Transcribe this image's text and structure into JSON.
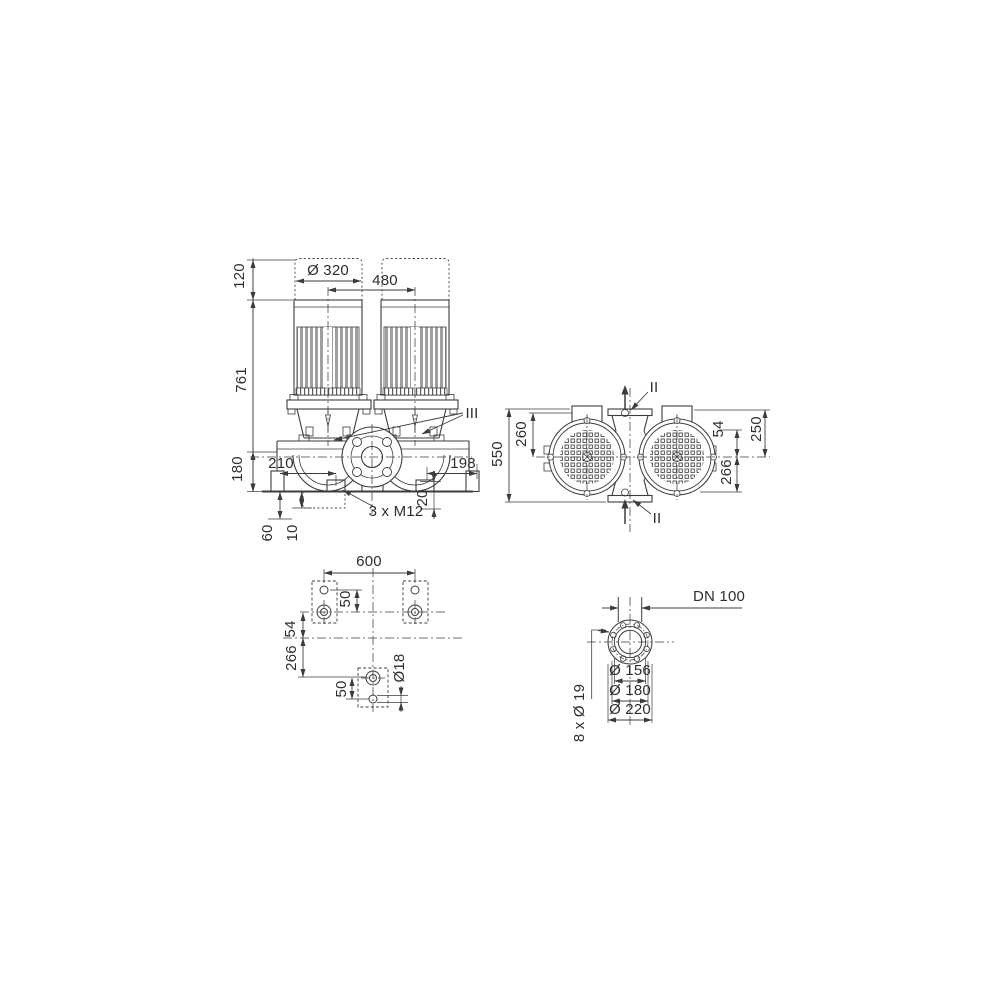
{
  "drawing": {
    "title": "Twin-head inline pump dimensional drawing",
    "colors": {
      "line": "#3c3c3c",
      "rib_fill": "#9f9f9f",
      "label": "#2e2e2e"
    },
    "front_view": {
      "dim_clearance_height": "120",
      "dim_motor_diameter": "Ø 320",
      "dim_motor_spacing": "480",
      "dim_total_height": "761",
      "dim_port_height": "180",
      "dim_left_offset": "210",
      "dim_right_offset": "198",
      "dim_foot_depth": "20",
      "thread_label": "3 x M12",
      "dim_foundation_60": "60",
      "dim_foundation_10": "10",
      "section_label": "III"
    },
    "top_view": {
      "dim_total_length": "550",
      "dim_top_to_axis": "260",
      "dim_bolt_offset": "54",
      "dim_width_250": "250",
      "dim_axis_to_bottom": "266",
      "section_label_top": "II",
      "section_label_bottom": "II"
    },
    "foundation_view": {
      "dim_bolt_span": "600",
      "dim_hole_offset_top": "50",
      "dim_axis_offset_54": "54",
      "dim_axis_offset_266": "266",
      "dim_hole_offset_bottom": "50",
      "dim_hole_diameter": "Ø18"
    },
    "flange_view": {
      "nominal_diameter": "DN 100",
      "dia_raised_face": "Ø 156",
      "dia_bolt_circle": "Ø 180",
      "dia_outer": "Ø 220",
      "bolt_holes_label": "8 x Ø 19"
    }
  }
}
